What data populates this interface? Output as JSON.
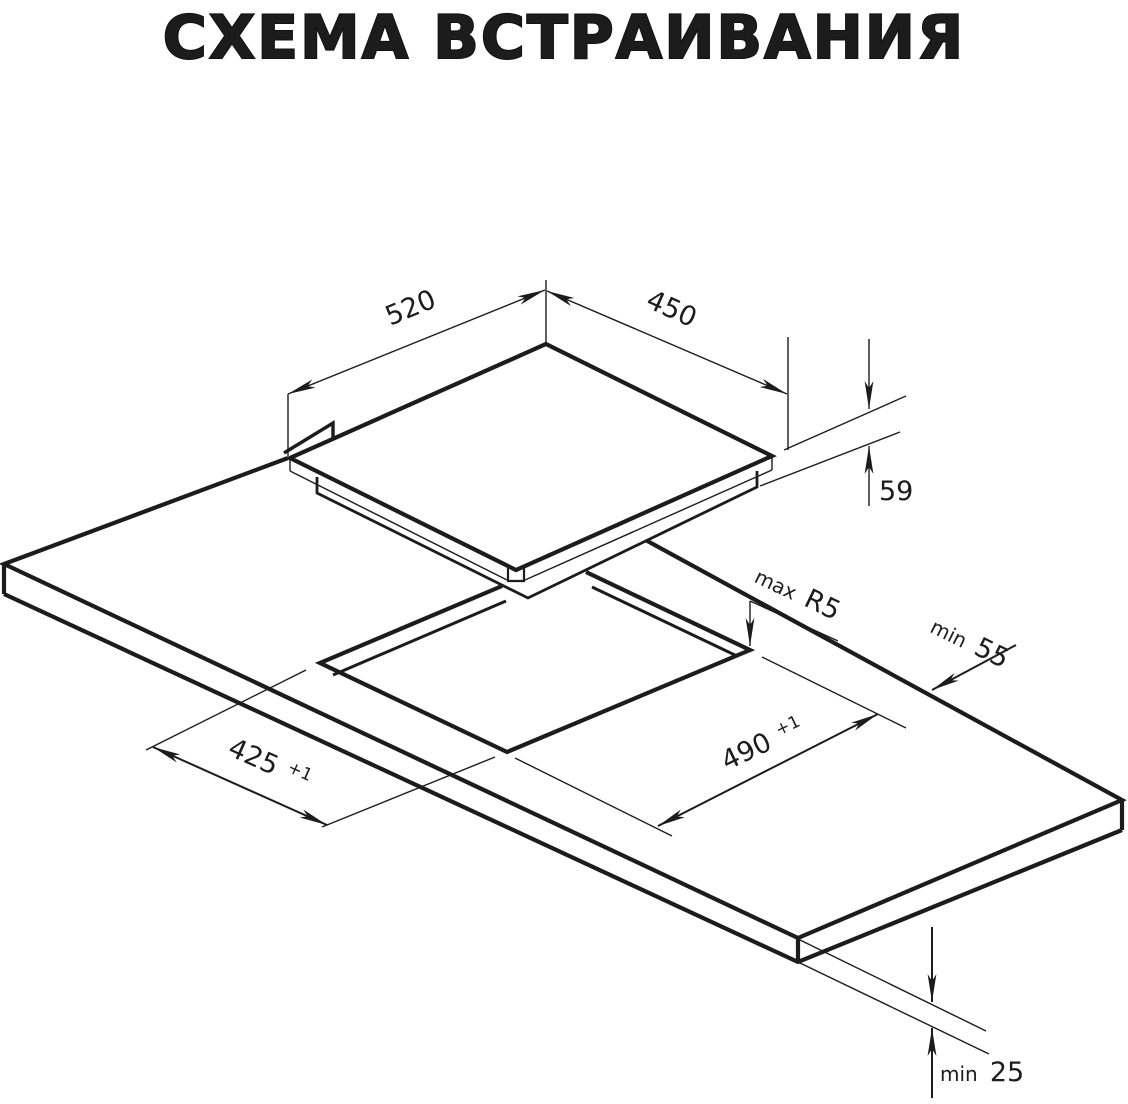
{
  "title": "СХЕМА ВСТРАИВАНИЯ",
  "dimensions": {
    "cooktop_width": {
      "value": "520"
    },
    "cooktop_depth": {
      "value": "450"
    },
    "cooktop_height": {
      "value": "59"
    },
    "cutout_width": {
      "value": "490",
      "tolerance": "+1"
    },
    "cutout_depth": {
      "value": "425",
      "tolerance": "+1"
    },
    "cutout_corner_radius": {
      "prefix": "max",
      "value": "R5"
    },
    "rear_edge_clearance": {
      "prefix": "min",
      "value": "55"
    },
    "worktop_thickness": {
      "prefix": "min",
      "value": "25"
    }
  },
  "colors": {
    "line": "#1c1c1c",
    "background": "#ffffff"
  }
}
